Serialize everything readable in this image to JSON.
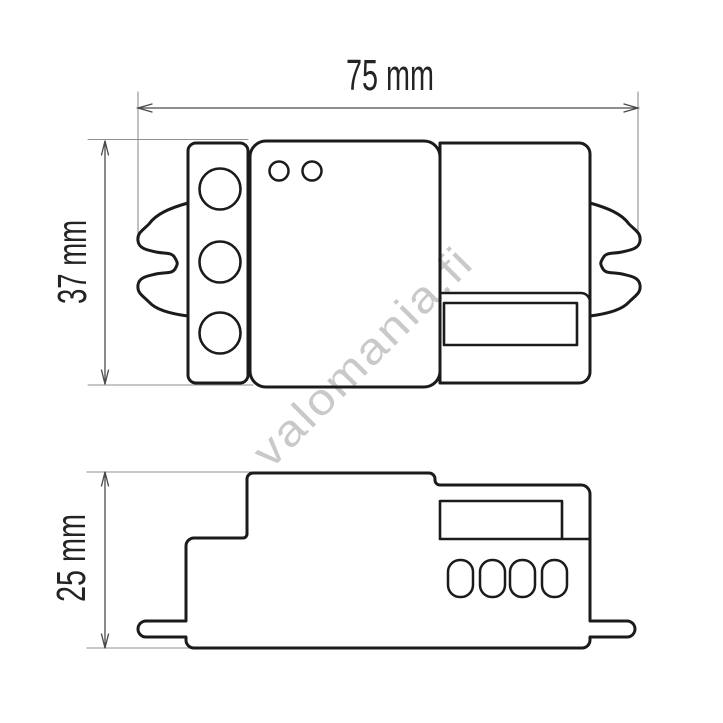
{
  "canvas": {
    "background": "#ffffff"
  },
  "watermark": {
    "text": "valomania.fi",
    "color": "#c9c9c9"
  },
  "labels": {
    "width": "75 mm",
    "height_top_view": "37 mm",
    "height_side_view": "25 mm"
  },
  "colors": {
    "outline": "#1b1b1b",
    "dimension": "#4a4a4a",
    "extension": "#8f8f8f",
    "label_text": "#242424"
  }
}
